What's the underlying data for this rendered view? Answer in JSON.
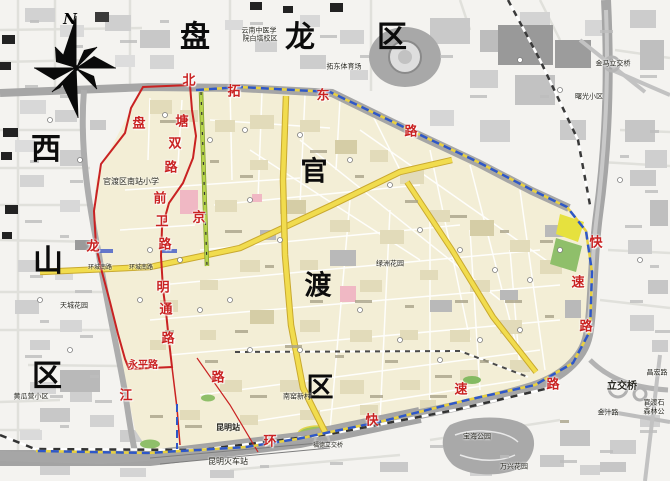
{
  "map": {
    "compass_label": "N",
    "district_labels": [
      {
        "text": "盘",
        "x": 195,
        "y": 38,
        "size": 30
      },
      {
        "text": "龙",
        "x": 300,
        "y": 38,
        "size": 30
      },
      {
        "text": "区",
        "x": 392,
        "y": 38,
        "size": 30
      },
      {
        "text": "西",
        "x": 46,
        "y": 150,
        "size": 30
      },
      {
        "text": "山",
        "x": 48,
        "y": 262,
        "size": 30
      },
      {
        "text": "区",
        "x": 47,
        "y": 377,
        "size": 30
      },
      {
        "text": "官",
        "x": 314,
        "y": 172,
        "size": 27
      },
      {
        "text": "渡",
        "x": 318,
        "y": 286,
        "size": 27
      },
      {
        "text": "区",
        "x": 320,
        "y": 388,
        "size": 27
      }
    ],
    "road_labels": [
      {
        "text": "北",
        "x": 189,
        "y": 81
      },
      {
        "text": "塘",
        "x": 182,
        "y": 122
      },
      {
        "text": "双",
        "x": 175,
        "y": 144
      },
      {
        "text": "路",
        "x": 171,
        "y": 168
      },
      {
        "text": "前",
        "x": 160,
        "y": 199
      },
      {
        "text": "卫",
        "x": 162,
        "y": 222
      },
      {
        "text": "路",
        "x": 165,
        "y": 245
      },
      {
        "text": "明",
        "x": 163,
        "y": 288
      },
      {
        "text": "通",
        "x": 166,
        "y": 310
      },
      {
        "text": "路",
        "x": 168,
        "y": 339
      },
      {
        "text": "盘",
        "x": 139,
        "y": 124
      },
      {
        "text": "龙",
        "x": 93,
        "y": 247
      },
      {
        "text": "江",
        "x": 126,
        "y": 396
      },
      {
        "text": "永平路",
        "x": 143,
        "y": 366,
        "size": 10
      },
      {
        "text": "京",
        "x": 199,
        "y": 218
      },
      {
        "text": "拓",
        "x": 234,
        "y": 92
      },
      {
        "text": "东",
        "x": 323,
        "y": 96
      },
      {
        "text": "路",
        "x": 411,
        "y": 132
      },
      {
        "text": "环",
        "x": 270,
        "y": 442
      },
      {
        "text": "快",
        "x": 372,
        "y": 421
      },
      {
        "text": "速",
        "x": 461,
        "y": 390
      },
      {
        "text": "路",
        "x": 553,
        "y": 385
      },
      {
        "text": "快",
        "x": 596,
        "y": 243
      },
      {
        "text": "速",
        "x": 578,
        "y": 283
      },
      {
        "text": "路",
        "x": 586,
        "y": 327
      },
      {
        "text": "路",
        "x": 218,
        "y": 378
      }
    ],
    "place_labels": [
      {
        "text": "云南中医学",
        "x": 259,
        "y": 31
      },
      {
        "text": "院白塔校区",
        "x": 260,
        "y": 39
      },
      {
        "text": "拓东体育场",
        "x": 344,
        "y": 67
      },
      {
        "text": "官渡区南站小学",
        "x": 131,
        "y": 182,
        "size": 8
      },
      {
        "text": "环城南路",
        "x": 100,
        "y": 268,
        "size": 6
      },
      {
        "text": "环城南路",
        "x": 141,
        "y": 268,
        "size": 6
      },
      {
        "text": "昆明站",
        "x": 228,
        "y": 428,
        "size": 8,
        "bold": true
      },
      {
        "text": "昆明火车站",
        "x": 228,
        "y": 462,
        "size": 8
      },
      {
        "text": "南窑新村",
        "x": 297,
        "y": 397
      },
      {
        "text": "黄瓜营小区",
        "x": 31,
        "y": 397
      },
      {
        "text": "天城花园",
        "x": 74,
        "y": 306
      },
      {
        "text": "绿洲花园",
        "x": 390,
        "y": 264
      },
      {
        "text": "宝海公园",
        "x": 477,
        "y": 437
      },
      {
        "text": "万兴花园",
        "x": 514,
        "y": 467
      },
      {
        "text": "福德立交桥",
        "x": 328,
        "y": 446,
        "size": 6
      },
      {
        "text": "立交桥",
        "x": 622,
        "y": 387,
        "size": 10,
        "bold": true
      },
      {
        "text": "金汁路",
        "x": 608,
        "y": 413
      },
      {
        "text": "官渡石",
        "x": 654,
        "y": 403
      },
      {
        "text": "森林公",
        "x": 654,
        "y": 412
      },
      {
        "text": "金马立交桥",
        "x": 613,
        "y": 64
      },
      {
        "text": "曙光小区",
        "x": 589,
        "y": 97
      },
      {
        "text": "昌宏路",
        "x": 657,
        "y": 373
      }
    ],
    "colors": {
      "zone_fill": "#f3eed6",
      "boundary_blue": "#2e57c9",
      "boundary_yellow": "#e8d040",
      "red_line": "#c92222",
      "yellow_road": "#f1dc4e",
      "green_road": "#b7d44e",
      "expressway": "#a6a6a6",
      "park_green": "#8fbf6a",
      "building_gray": "#d2d2d2",
      "hospital_pink": "#f0b8c4"
    }
  }
}
